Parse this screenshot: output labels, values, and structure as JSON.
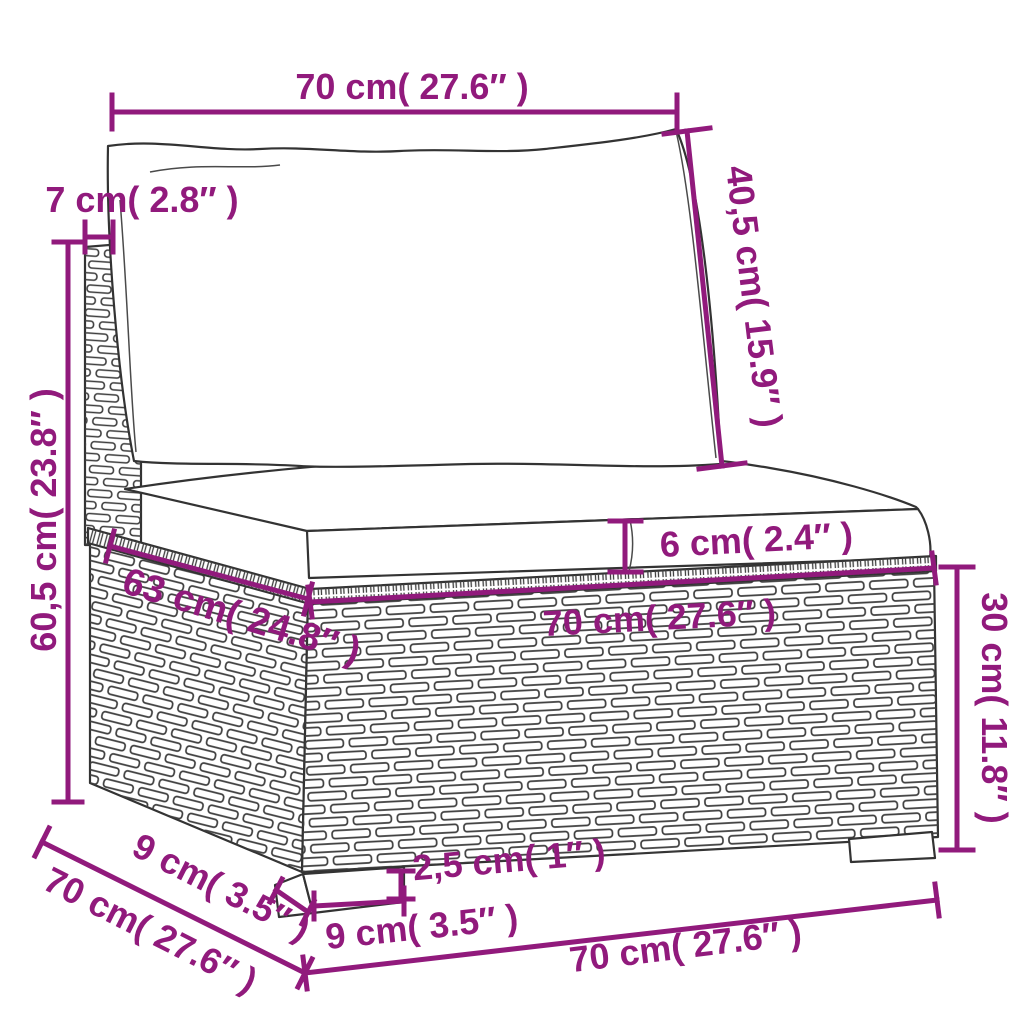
{
  "figure": {
    "type": "product-dimension-diagram",
    "subject": "poly-rattan sofa middle section with cushions"
  },
  "colors": {
    "dimension_accent": "#911a7c",
    "line_art": "#333333",
    "background": "#ffffff"
  },
  "dimensions": {
    "top_width": {
      "label": "70 cm( 27.6″ )",
      "cm": "70",
      "inch": "27.6"
    },
    "back_height": {
      "label": "40,5 cm( 15.9″ )",
      "cm": "40,5",
      "inch": "15.9"
    },
    "post_width": {
      "label": "7 cm( 2.8″ )",
      "cm": "7",
      "inch": "2.8"
    },
    "left_height": {
      "label": "60,5 cm( 23.8″ )",
      "cm": "60,5",
      "inch": "23.8"
    },
    "seat_depth": {
      "label": "63 cm( 24.8″ )",
      "cm": "63",
      "inch": "24.8"
    },
    "seat_width": {
      "label": "70 cm( 27.6″ )",
      "cm": "70",
      "inch": "27.6"
    },
    "cushion_thickness": {
      "label": "6 cm( 2.4″ )",
      "cm": "6",
      "inch": "2.4"
    },
    "base_height": {
      "label": "30 cm( 11.8″ )",
      "cm": "30",
      "inch": "11.8"
    },
    "leg_depth": {
      "label": "9 cm( 3.5″ )",
      "cm": "9",
      "inch": "3.5"
    },
    "side_depth": {
      "label": "70 cm( 27.6″ )",
      "cm": "70",
      "inch": "27.6"
    },
    "leg_height": {
      "label": "2,5 cm( 1″ )",
      "cm": "2,5",
      "inch": "1"
    },
    "leg_width": {
      "label": "9 cm( 3.5″ )",
      "cm": "9",
      "inch": "3.5"
    },
    "bottom_width": {
      "label": "70 cm( 27.6″ )",
      "cm": "70",
      "inch": "27.6"
    }
  }
}
